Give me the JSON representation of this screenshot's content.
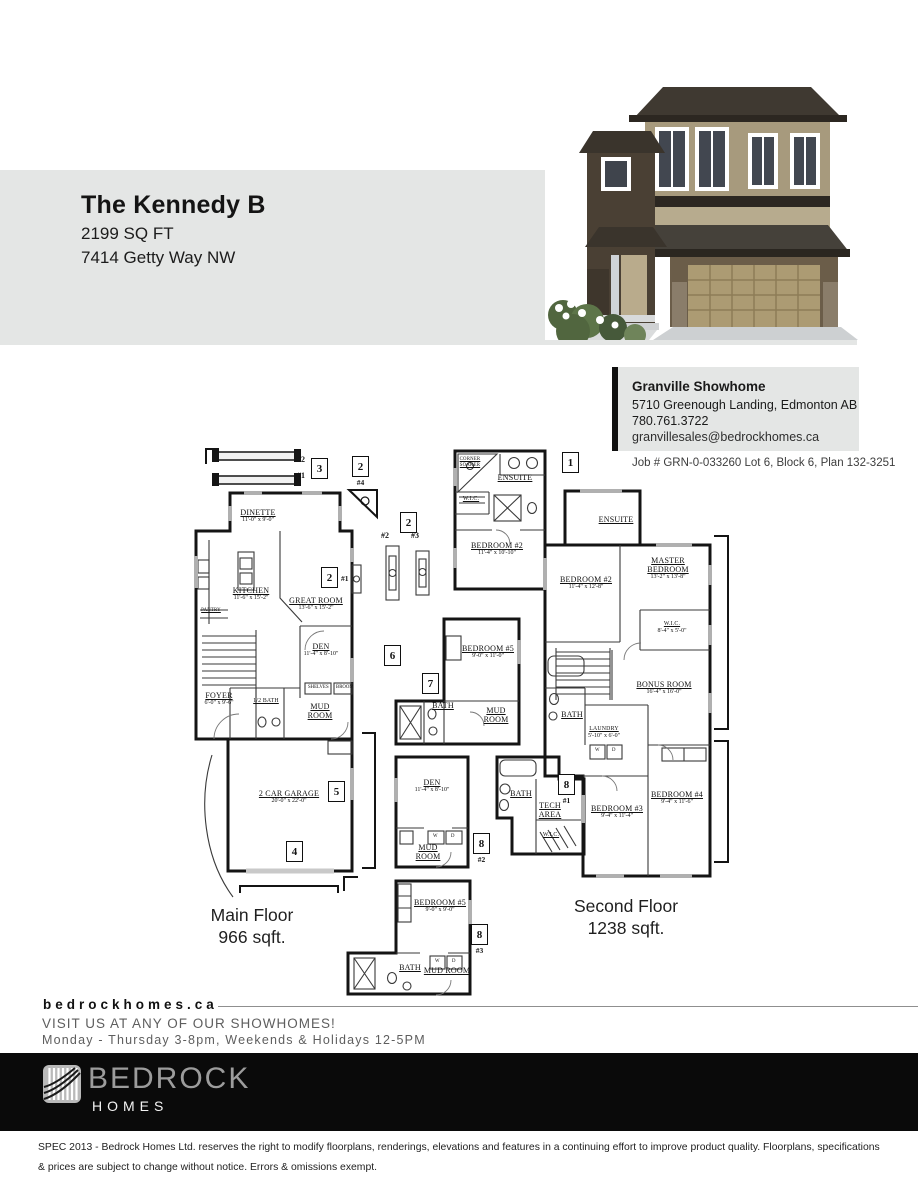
{
  "header": {
    "title": "The Kennedy B",
    "sqft": "2199 SQ FT",
    "address": "7414 Getty Way NW"
  },
  "showhome": {
    "name": "Granville Showhome",
    "address": "5710 Greenough Landing, Edmonton AB",
    "phone": "780.761.3722",
    "email": "granvillesales@bedrockhomes.ca",
    "job": "Job # GRN-0-033260 Lot 6, Block 6, Plan 132-3251"
  },
  "main_floor": {
    "caption": "Main Floor",
    "area": "966 sqft.",
    "rooms": [
      {
        "name": "DINETTE",
        "dims": "11'-0\" x 9'-0\""
      },
      {
        "name": "KITCHEN",
        "dims": "11'-6\" x 15'-2\""
      },
      {
        "name": "GREAT ROOM",
        "dims": "13'-6\" x 15'-2\""
      },
      {
        "name": "DEN",
        "dims": "11'-4\" x 8'-10\""
      },
      {
        "name": "FOYER",
        "dims": "6'-0\" x 9'-6\""
      },
      {
        "name": "1/2 BATH",
        "dims": ""
      },
      {
        "name": "MUD ROOM",
        "dims": ""
      },
      {
        "name": "2 CAR GARAGE",
        "dims": "20'-0\" x 22'-0\""
      },
      {
        "name": "PANTRY",
        "dims": ""
      }
    ],
    "small_labels": [
      "SHELVES",
      "BROOM"
    ]
  },
  "second_floor": {
    "caption": "Second Floor",
    "area": "1238 sqft.",
    "rooms": [
      {
        "name": "ENSUITE",
        "dims": ""
      },
      {
        "name": "BEDROOM #2",
        "dims": "11'-4\" x 12'-8\""
      },
      {
        "name": "MASTER BEDROOM",
        "dims": "13'-2\" x 13'-8\""
      },
      {
        "name": "W.I.C.",
        "dims": "8'-4\" x 5'-0\""
      },
      {
        "name": "BONUS ROOM",
        "dims": "16'-4\" x 16'-0\""
      },
      {
        "name": "BATH",
        "dims": ""
      },
      {
        "name": "LAUNDRY",
        "dims": "5'-10\" x 6'-0\""
      },
      {
        "name": "BEDROOM #3",
        "dims": "9'-4\" x 11'-4\""
      },
      {
        "name": "BEDROOM #4",
        "dims": "9'-4\" x 11'-6\""
      }
    ]
  },
  "options": {
    "boxes": [
      {
        "num": "3",
        "tag": ""
      },
      {
        "num": "2",
        "tag": "#4"
      },
      {
        "num": "2",
        "tag": "#1"
      },
      {
        "num": "1",
        "tag": ""
      },
      {
        "num": "2",
        "tag": ""
      },
      {
        "num": "6",
        "tag": ""
      },
      {
        "num": "7",
        "tag": ""
      },
      {
        "num": "5",
        "tag": ""
      },
      {
        "num": "4",
        "tag": ""
      },
      {
        "num": "8",
        "tag": "#2"
      },
      {
        "num": "8",
        "tag": "#1"
      },
      {
        "num": "8",
        "tag": "#3"
      }
    ],
    "window_tags": [
      "#2",
      "#1",
      "#2",
      "#3"
    ],
    "rooms": [
      {
        "name": "ENSUITE",
        "dims": ""
      },
      {
        "name": "W.I.C.",
        "dims": ""
      },
      {
        "name": "CORNER SOAKER",
        "dims": ""
      },
      {
        "name": "BEDROOM #2",
        "dims": "11'-4\" x 10'-10\""
      },
      {
        "name": "BEDROOM #5",
        "dims": "9'-0\" x 11'-0\""
      },
      {
        "name": "BATH",
        "dims": ""
      },
      {
        "name": "MUD ROOM",
        "dims": ""
      },
      {
        "name": "DEN",
        "dims": "11'-4\" x 8'-10\""
      },
      {
        "name": "MUD ROOM",
        "dims": ""
      },
      {
        "name": "BATH",
        "dims": ""
      },
      {
        "name": "TECH AREA",
        "dims": ""
      },
      {
        "name": "W.I.C.",
        "dims": ""
      },
      {
        "name": "BEDROOM #5",
        "dims": "9'-0\" x 9'-0\""
      },
      {
        "name": "BATH",
        "dims": ""
      },
      {
        "name": "MUD ROOM",
        "dims": ""
      }
    ],
    "appliance_labels": [
      "W",
      "D"
    ]
  },
  "footer": {
    "website": "bedrockhomes.ca",
    "visit": "VISIT US AT ANY OF OUR SHOWHOMES!",
    "hours": "Monday - Thursday 3-8pm, Weekends & Holidays 12-5PM",
    "logo_line1": "BEDROCK",
    "logo_line2": "HOMES",
    "disclaimer": "SPEC 2013 - Bedrock Homes Ltd. reserves the right to modify floorplans, renderings, elevations and features in a continuing effort to improve product quality. Floorplans, specifications & prices are subject to change without notice.  Errors & omissions exempt."
  }
}
